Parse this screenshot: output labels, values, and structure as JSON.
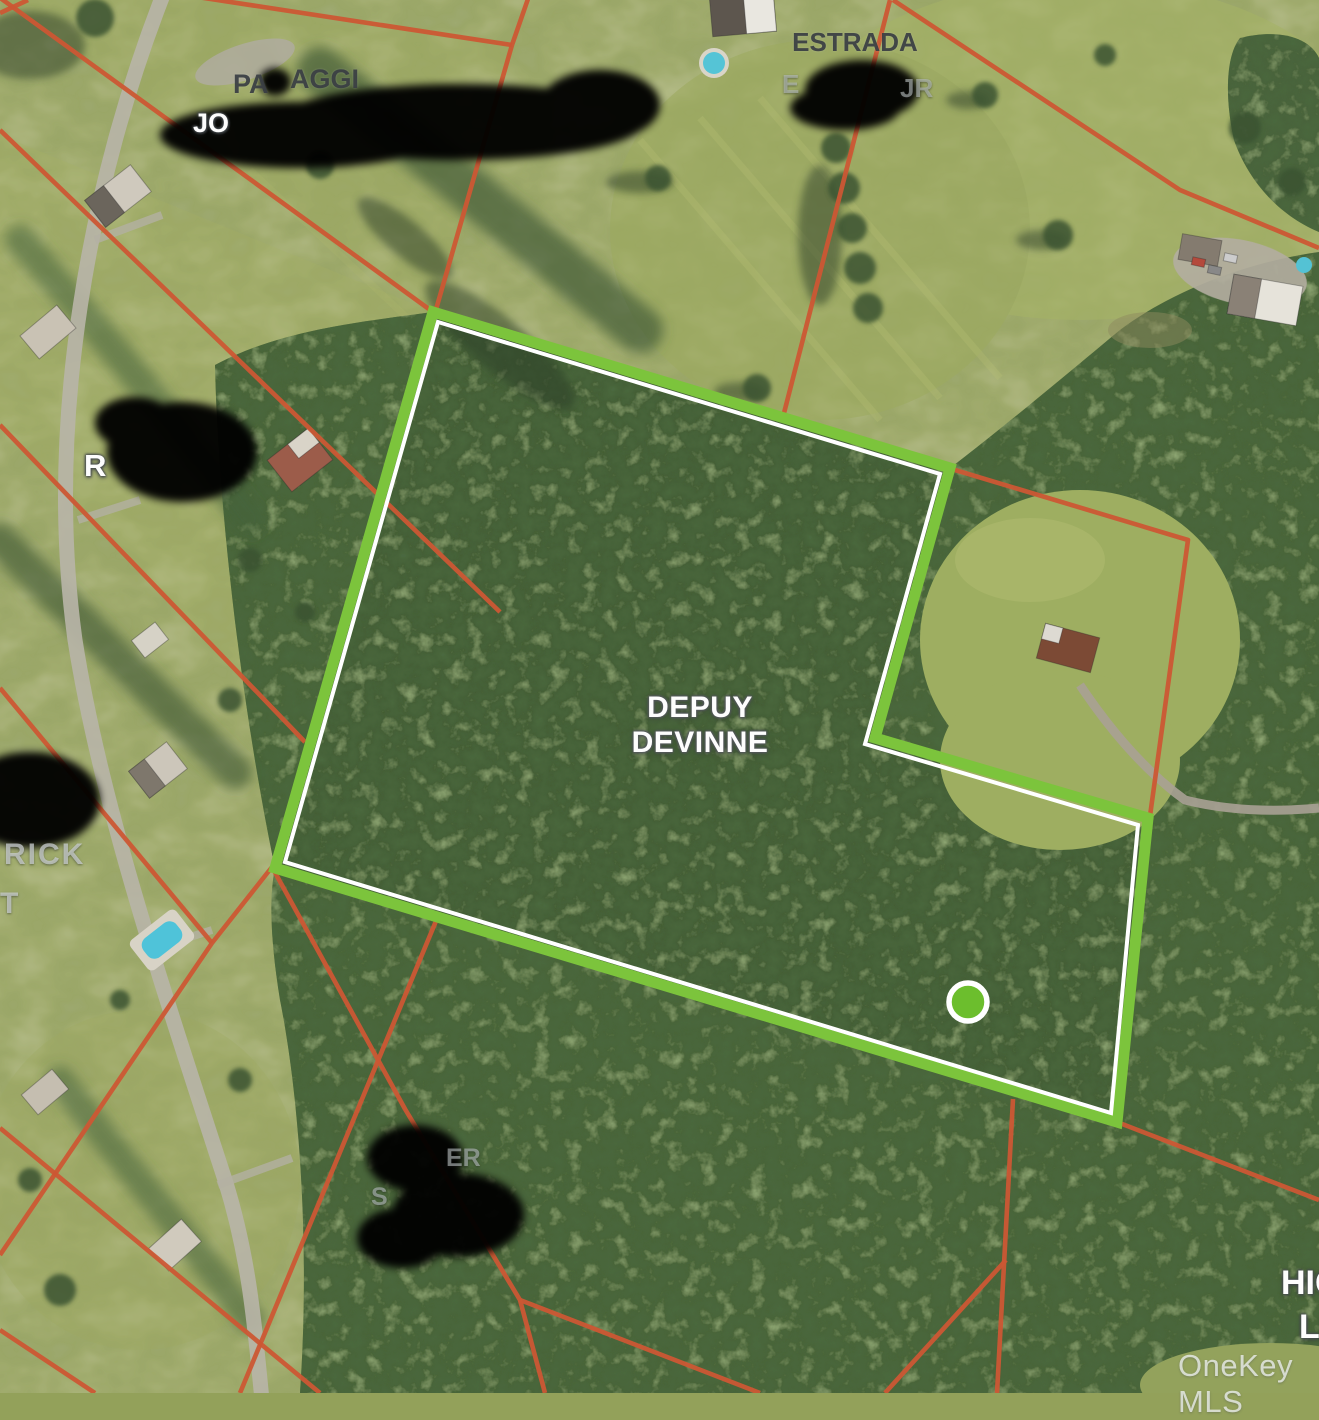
{
  "map": {
    "attribution": "OneKey MLS",
    "subject_parcel": {
      "label_line1": "DEPUY",
      "label_line2": "DEVINNE",
      "outline_color": "#7CC43C",
      "inner_outline_color": "#FFFFFF",
      "outer_points": "433,312 950,468 875,738 1148,818 1117,1122 275,868",
      "inner_points": "438,322 940,474 865,744 1138,825 1111,1113 285,862",
      "marker": {
        "cx": "968",
        "cy": "1002",
        "r": "19",
        "fill": "#6CBE2D"
      }
    },
    "boundary_lines": {
      "color": "#CC5734",
      "segments": [
        {
          "points": "-8,-8 433,312"
        },
        {
          "points": "178,-6 512,45"
        },
        {
          "points": "529,-4 512,45 435,313"
        },
        {
          "points": "0,130 500,612"
        },
        {
          "points": "0,425 305,742"
        },
        {
          "points": "0,688 212,943"
        },
        {
          "points": "272,867 212,943 0,1255"
        },
        {
          "points": "272,867 405,1109 520,1300 545,1393"
        },
        {
          "points": "520,1300 760,1393"
        },
        {
          "points": "436,921 240,1393"
        },
        {
          "points": "0,1128 320,1393"
        },
        {
          "points": "0,1330 95,1393"
        },
        {
          "points": "893,0 1180,190 1319,248"
        },
        {
          "points": "890,0 783,417"
        },
        {
          "points": "955,470 1188,540 1150,816"
        },
        {
          "points": "1117,1122 1319,1200"
        },
        {
          "points": "1013,1099 997,1393"
        },
        {
          "points": "1006,1260 885,1393"
        },
        {
          "points": "0,13 28,0"
        }
      ]
    },
    "neighbor_labels": {
      "estrada_line1": "ESTRADA",
      "estrada_frag_a": "E",
      "estrada_frag_b": "JR",
      "passaggi_frag_a": "PA",
      "passaggi_frag_b": "AGGI",
      "passaggi_frag_c": "JO",
      "west_frag_a": "R",
      "west_frag_b": "RICK",
      "west_frag_c": "T",
      "south_frag_a": "ER",
      "south_frag_b": "S",
      "southeast_frag_a": "HIG",
      "southeast_frag_b": "LI"
    }
  }
}
